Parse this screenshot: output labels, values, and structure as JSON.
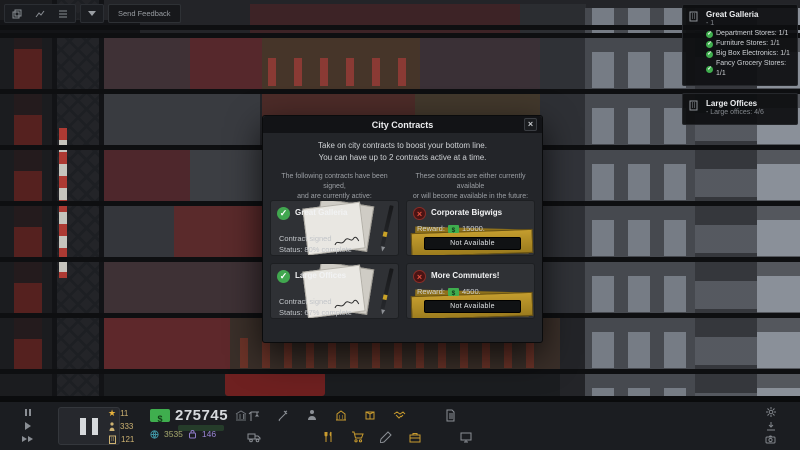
{
  "topbar": {
    "send_feedback_label": "Send Feedback"
  },
  "goals_panel": {
    "cards": [
      {
        "title": "Great Galleria",
        "subtitle": "- 1",
        "items": [
          {
            "label": "Department Stores: 1/1"
          },
          {
            "label": "Furniture Stores: 1/1"
          },
          {
            "label": "Big Box Electronics: 1/1"
          },
          {
            "label": "Fancy Grocery Stores: 1/1"
          }
        ]
      },
      {
        "title": "Large Offices",
        "subtitle": "- Large offices: 4/6",
        "items": []
      }
    ]
  },
  "modal": {
    "title": "City Contracts",
    "close_label": "×",
    "intro_line1": "Take on city contracts to boost your bottom line.",
    "intro_line2": "You can have up to 2 contracts active at a time.",
    "signed_header_line1": "The following contracts have been signed,",
    "signed_header_line2": "and are currently active:",
    "available_header_line1": "These contracts are either currently available",
    "available_header_line2": "or will become available in the future:",
    "signed": [
      {
        "name": "Great Galleria",
        "status_line1": "Contract signed",
        "status_line2": "Status: 80% complete"
      },
      {
        "name": "Large Offices",
        "status_line1": "Contract signed",
        "status_line2": "Status: 67% complete"
      }
    ],
    "available": [
      {
        "name": "Corporate Bigwigs",
        "reward_label": "Reward:",
        "reward_value": "15000.",
        "button_label": "Not Available"
      },
      {
        "name": "More Commuters!",
        "reward_label": "Reward:",
        "reward_value": "4500.",
        "button_label": "Not Available"
      }
    ]
  },
  "hud": {
    "prestige": "11",
    "population": "333",
    "workers": "121",
    "money": "275745",
    "traffic": "3535",
    "influence": "146"
  },
  "icons": {
    "toolbar_row1": [
      "crane-icon",
      "tools-icon",
      "worker-icon",
      "building-icon",
      "box-icon",
      "handshake-icon",
      "document-icon"
    ],
    "toolbar_row2": [
      "truck-icon",
      "utensils-icon",
      "cart-icon",
      "pencil-icon",
      "briefcase-icon",
      "monitor-icon"
    ],
    "system": [
      "gear-icon",
      "download-icon",
      "camera-icon"
    ]
  },
  "colors": {
    "accent_green": "#3fae4e",
    "accent_gold": "#c99b2e",
    "accent_red": "#e0503f",
    "money_green": "#3fae4e",
    "influence_purple": "#9a86d6"
  }
}
